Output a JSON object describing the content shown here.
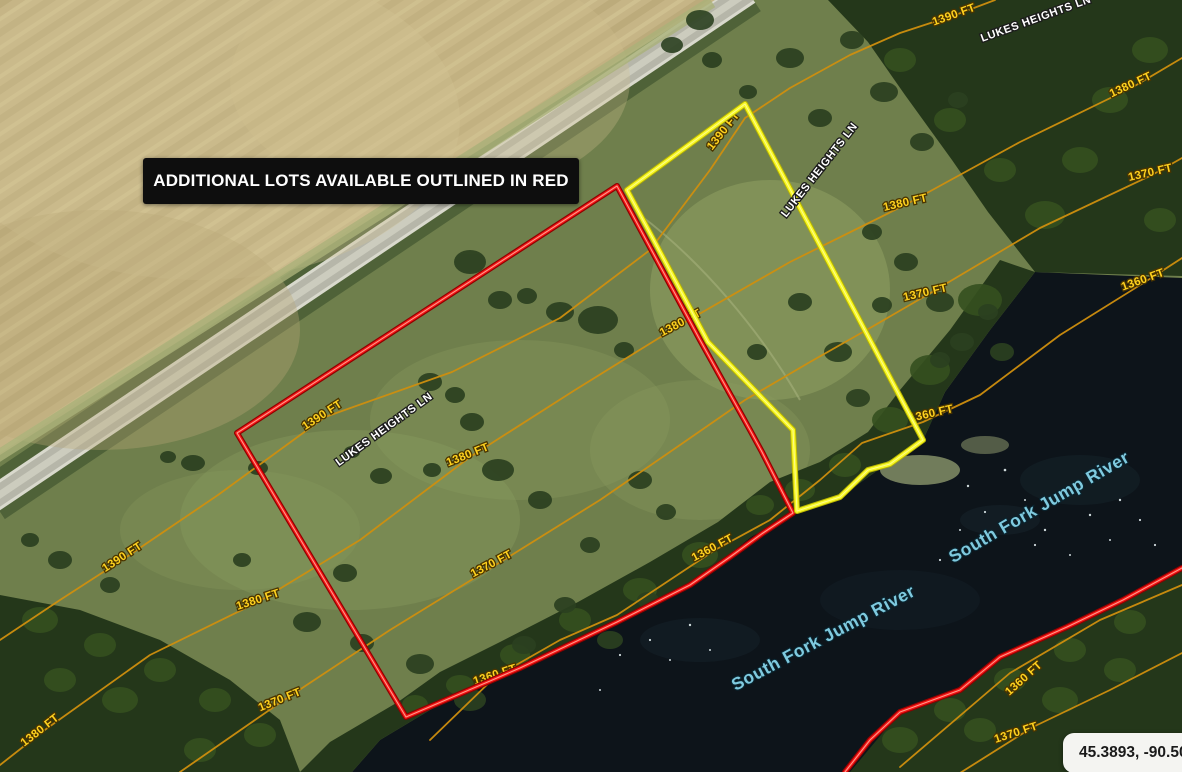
{
  "banner": {
    "text": "ADDITIONAL LOTS AVAILABLE OUTLINED IN RED",
    "bg_color": "#0e0e0e",
    "text_color": "#ffffff"
  },
  "coordinates_badge": {
    "text": "45.3893, -90.5094",
    "bg_color": "#f4f4f1",
    "text_color": "#1a1a1a"
  },
  "map": {
    "road_name": "LUKES HEIGHTS LN",
    "river_name": "South Fork Jump River",
    "available_lot_outline_color": "#f61515",
    "featured_lot_outline_color": "#f8f826",
    "contour_line_color": "#cf8f0e",
    "contour_label_color": "#ffd21f",
    "river_label_color": "#7fcadf",
    "road_labels": [
      {
        "text": "LUKES HEIGHTS LN"
      },
      {
        "text": "LUKES HEIGHTS LN"
      },
      {
        "text": "LUKES HEIGHTS LN"
      }
    ],
    "river_labels": [
      {
        "text": "South Fork Jump River"
      },
      {
        "text": "South Fork Jump River"
      }
    ],
    "contour_labels": [
      {
        "text": "1390 FT"
      },
      {
        "text": "1380 FT"
      },
      {
        "text": "1370 FT"
      },
      {
        "text": "1360 FT"
      },
      {
        "text": "1390 FT"
      },
      {
        "text": "1380 FT"
      },
      {
        "text": "1370 FT"
      },
      {
        "text": "1360 FT"
      },
      {
        "text": "1380 FT"
      },
      {
        "text": "1390 FT"
      },
      {
        "text": "1380 FT"
      },
      {
        "text": "1390 FT"
      },
      {
        "text": "1380 FT"
      },
      {
        "text": "1370 FT"
      },
      {
        "text": "1380 FT"
      },
      {
        "text": "1370 FT"
      },
      {
        "text": "1360 FT"
      },
      {
        "text": "1360 FT"
      },
      {
        "text": "1360 FT"
      },
      {
        "text": "1370 FT"
      }
    ]
  }
}
